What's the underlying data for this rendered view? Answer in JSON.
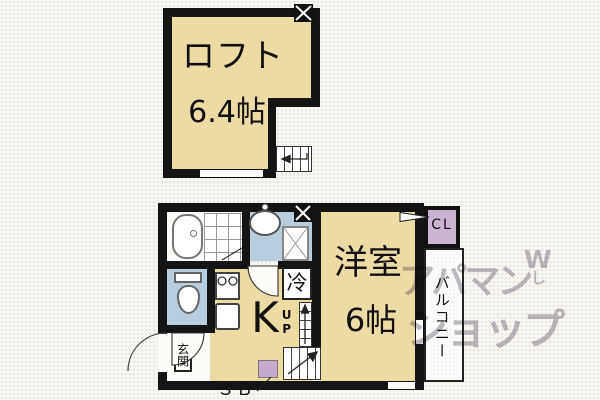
{
  "loft": {
    "label": "ロフト",
    "size": "6.4帖"
  },
  "main": {
    "kitchen_label": "K",
    "up_label": "UP",
    "fridge_label": "冷",
    "room_label": "洋室",
    "room_size": "6帖",
    "closet_label": "CL",
    "balcony_label": "バルコニー",
    "entrance_label": "玄関",
    "shoebox_label": "ＳＢ"
  },
  "watermark": {
    "line1": "アパマン",
    "line2": "ショップ",
    "mark1": "W",
    "mark2": "し"
  },
  "colors": {
    "tan": "#ecdca4",
    "blue": "#b8cede",
    "purple": "#cbb4d1",
    "sb-purple": "#c5aacb",
    "wall": "#141414",
    "bg": "#f7f6f1",
    "watermark": "rgba(116,104,126,0.45)"
  }
}
